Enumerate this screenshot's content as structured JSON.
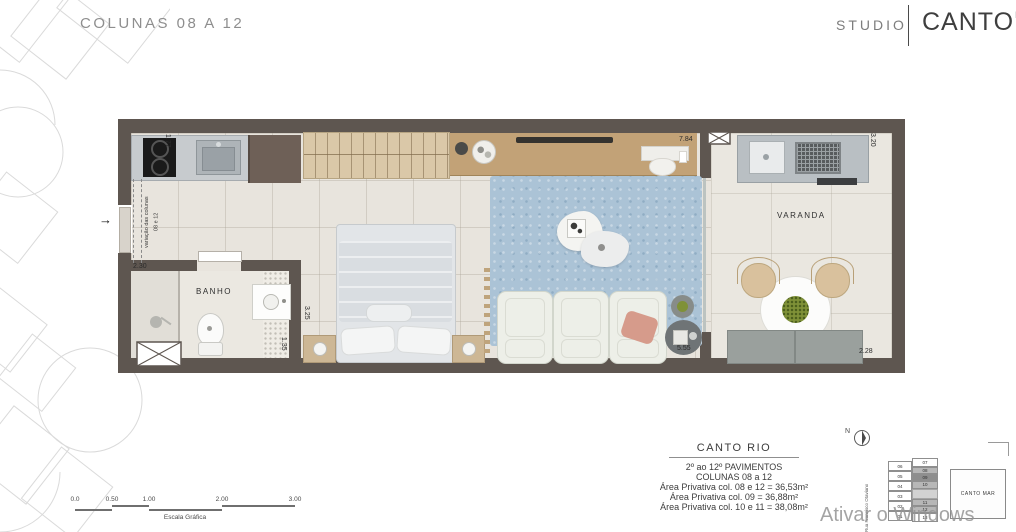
{
  "header": {
    "title": "COLUNAS 08 A 12",
    "brand": {
      "left": "STUDIO",
      "name": "CANTO",
      "sup": "RIO"
    }
  },
  "plan": {
    "rooms": {
      "banho": "BANHO",
      "varanda": "VARANDA"
    },
    "notes": {
      "column_variation_l1": "variação das colunas",
      "column_variation_l2": "08 e 12"
    },
    "dims": {
      "d177": "1.77",
      "d230": "2.30",
      "d135": "1.35",
      "d325": "3.25",
      "d784": "7.84",
      "d555": "5.55",
      "d320": "3.20",
      "d228": "2.28"
    },
    "entry_arrow": "→"
  },
  "scalebar": {
    "label": "Escala Gráfica",
    "ticks": [
      {
        "t": "0.0",
        "x": 0
      },
      {
        "t": "0.50",
        "x": 37
      },
      {
        "t": "1.00",
        "x": 74
      },
      {
        "t": "2.00",
        "x": 147
      },
      {
        "t": "3.00",
        "x": 220
      }
    ]
  },
  "infobox": {
    "title": "CANTO RIO",
    "lines": [
      "2º ao 12º PAVIMENTOS",
      "COLUNAS 08 a 12",
      "Área Privativa col. 08 e 12 = 36,53m²",
      "Área Privativa col. 09 = 36,88m²",
      "Área Privativa col. 10 e 11 = 38,08m²"
    ]
  },
  "keyplan": {
    "north": "N",
    "street": "Rua Francisco Otaviano",
    "left_col": [
      "06",
      "05",
      "04",
      "03",
      "02",
      "01"
    ],
    "right_col": [
      "07",
      "08",
      "09",
      "10",
      "",
      "11",
      "12",
      "13"
    ],
    "highlighted": [
      "08",
      "10",
      "11",
      "12"
    ],
    "strong": [
      "09"
    ],
    "building": "CANTO MAR"
  },
  "watermark": "Ativar o Windows",
  "colors": {
    "wall": "#5e5650",
    "floor": "#e8e4dd",
    "rug": "#abc3d6",
    "wood": "#c2a277",
    "wardrobe": "#dac8a8",
    "counter": "#c7cbce",
    "highlight_unit": "#b7b7b7",
    "strong_unit": "#8e8e8e",
    "title_gray": "#8e8e8e"
  }
}
